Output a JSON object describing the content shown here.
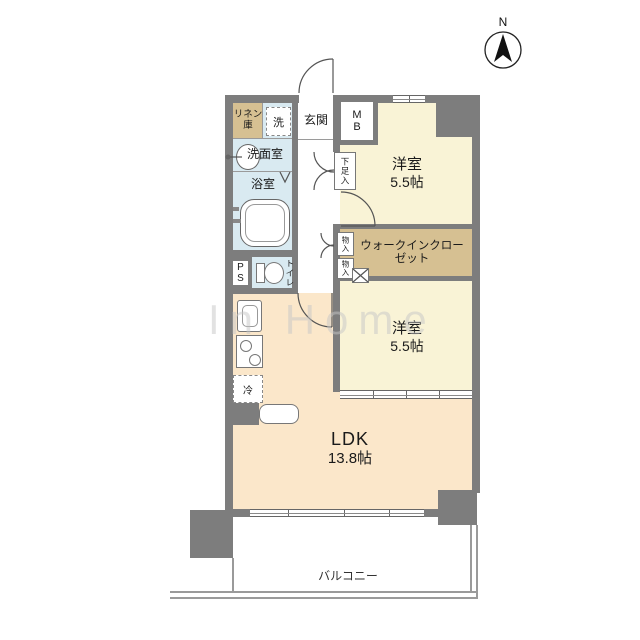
{
  "colors": {
    "wall": "#7d7d7d",
    "cream": "#f9f3d6",
    "tan": "#d6c092",
    "peach": "#fbe7ca",
    "blue": "#d9eaf1"
  },
  "compass": {
    "label": "N"
  },
  "watermark": {
    "text": "In Home"
  },
  "rooms": {
    "linen": {
      "label": "リネン庫"
    },
    "washer_room": {
      "label": "洗"
    },
    "entrance": {
      "label": "玄関"
    },
    "meter_box": {
      "label": "MB"
    },
    "washroom": {
      "label": "洗面室"
    },
    "bathroom": {
      "label": "浴室"
    },
    "shoe_storage": {
      "label": "下足入"
    },
    "bedroom1": {
      "label": "洋室",
      "size": "5.5帖"
    },
    "wic": {
      "label": "ウォークインクローゼット"
    },
    "storage_upper": {
      "label": "物入"
    },
    "storage_lower": {
      "label": "物入"
    },
    "pipe_space": {
      "label": "PS"
    },
    "toilet": {
      "label": "トイレ"
    },
    "fridge": {
      "label": "冷"
    },
    "bedroom2": {
      "label": "洋室",
      "size": "5.5帖"
    },
    "ldk": {
      "label": "LDK",
      "size": "13.8帖"
    },
    "balcony": {
      "label": "バルコニー"
    }
  }
}
